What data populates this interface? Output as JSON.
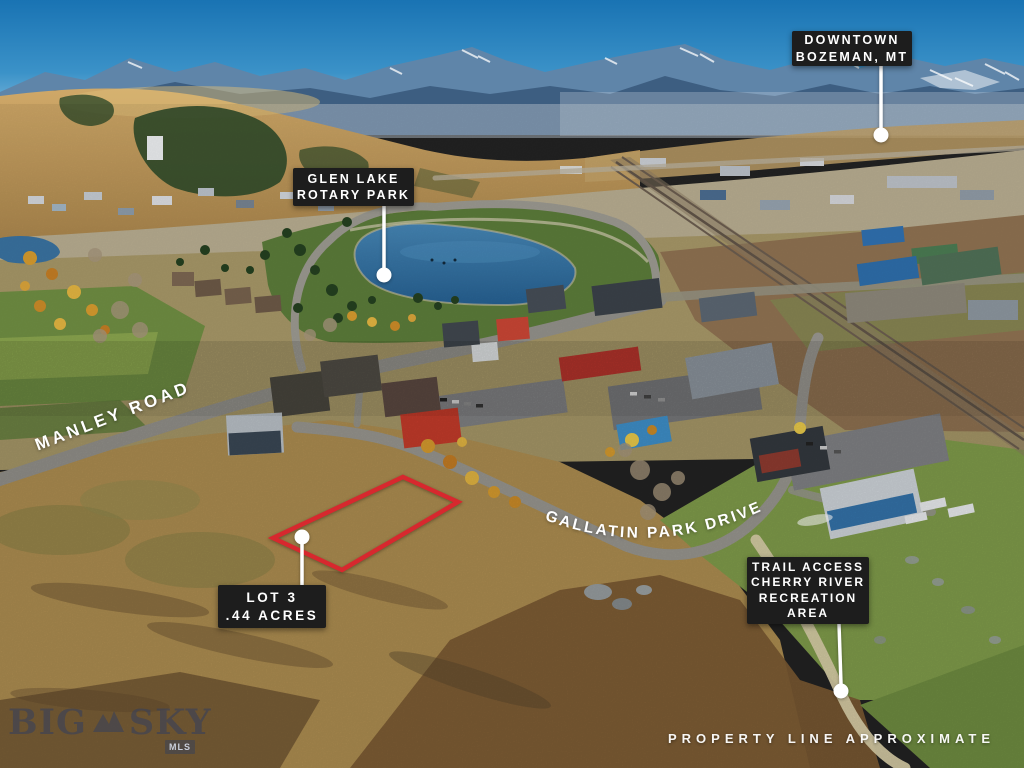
{
  "image_type": "aerial-property-listing-photo",
  "location": "Bozeman, MT",
  "annotations": {
    "downtown": {
      "lines": [
        "DOWNTOWN",
        "BOZEMAN, MT"
      ]
    },
    "glen_lake": {
      "lines": [
        "GLEN LAKE",
        "ROTARY PARK"
      ]
    },
    "lot": {
      "lines": [
        "LOT 3",
        ".44 ACRES"
      ]
    },
    "trail_access": {
      "lines": [
        "TRAIL ACCESS",
        "CHERRY RIVER",
        "RECREATION",
        "AREA"
      ]
    },
    "roads": {
      "manley": "MANLEY ROAD",
      "gallatin": "GALLATIN PARK DRIVE"
    },
    "property_line_note": "PROPERTY LINE APPROXIMATE"
  },
  "watermark": {
    "word1": "BIG",
    "word2": "SKY",
    "badge": "MLS"
  },
  "colors": {
    "label_bg": "#1d1d1d",
    "label_text": "#ffffff",
    "lot_outline": "#d7282e",
    "marker": "#ffffff"
  }
}
